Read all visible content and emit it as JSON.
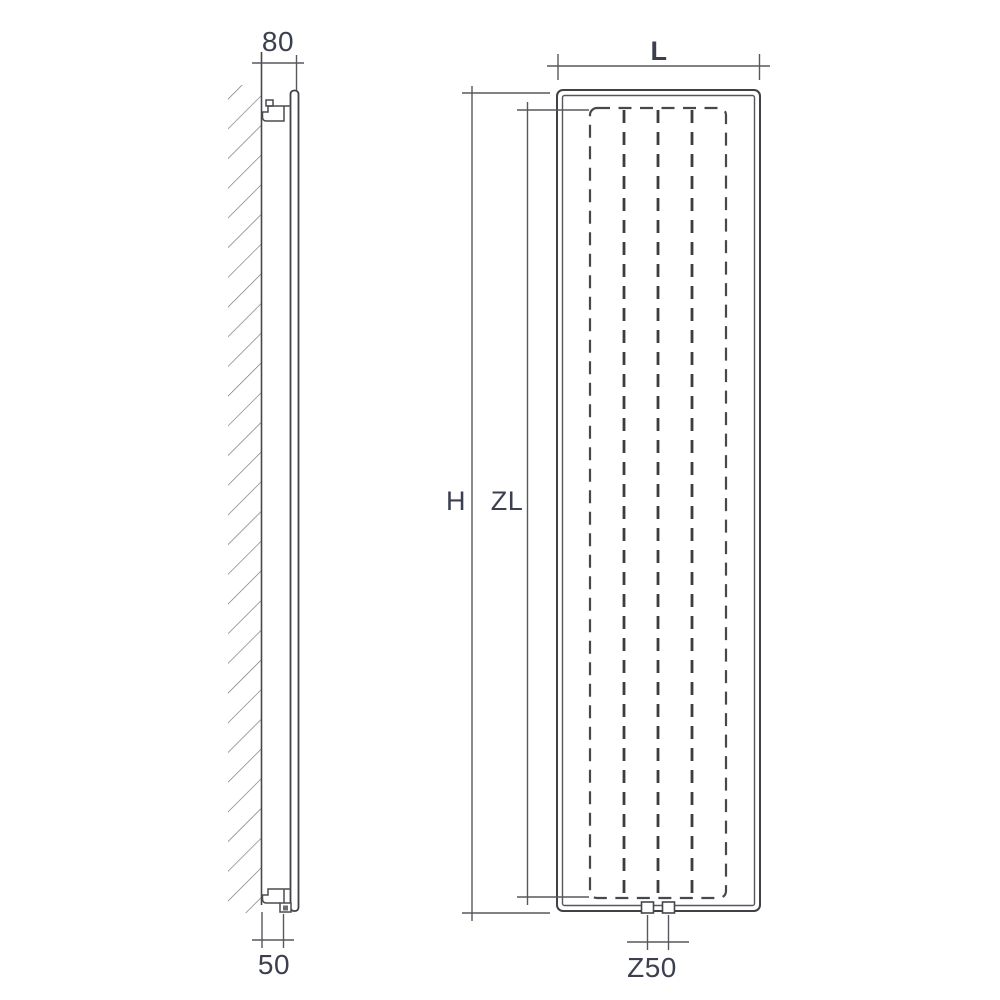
{
  "drawing": {
    "labels": {
      "depth": "80",
      "wall_to_pipe": "50",
      "width": "L",
      "height": "H",
      "element_height": "ZL",
      "connection_spacing": "Z50"
    },
    "colors": {
      "background": "#ffffff",
      "outline": "#3f4145",
      "inner_line": "#54565a",
      "hidden_dashed": "#46484c",
      "dimension_line": "#56585d",
      "hatch": "#6f7175",
      "label_text": "#3c404e"
    }
  }
}
